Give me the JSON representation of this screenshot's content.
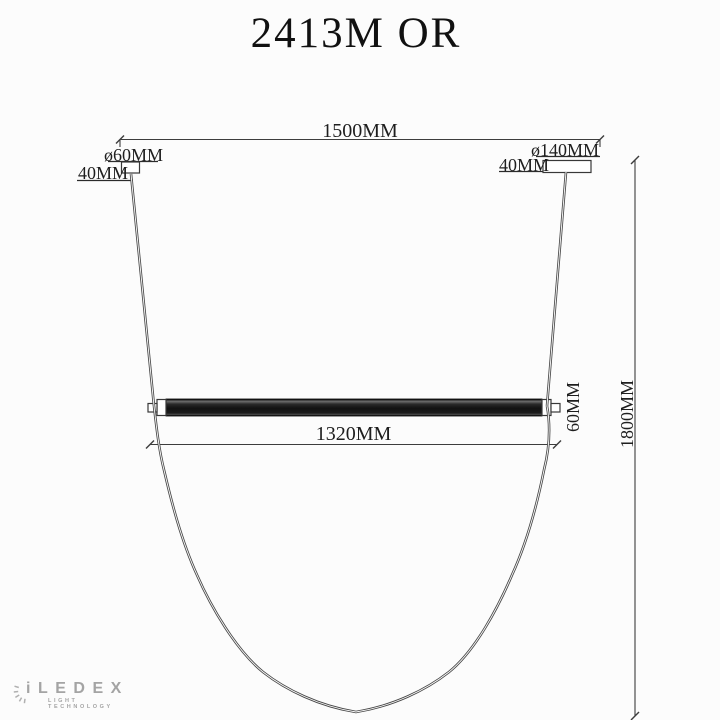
{
  "title": "2413M OR",
  "drawing": {
    "overall_width": "1500MM",
    "left_canopy": {
      "diameter": "ø60MM",
      "height": "40MM"
    },
    "right_canopy": {
      "diameter": "ø140MM",
      "height": "40MM"
    },
    "bar_length": "1320MM",
    "bar_diameter": "60MM",
    "suspension_height": "1800MM"
  },
  "logo": {
    "brand": "iLEDEX",
    "tagline": "LIGHT TECHNOLOGY"
  },
  "colors": {
    "line": "#3d3d3d",
    "bar": "#161616",
    "logo": "#a4a4a4",
    "background": "#fcfcfc"
  }
}
